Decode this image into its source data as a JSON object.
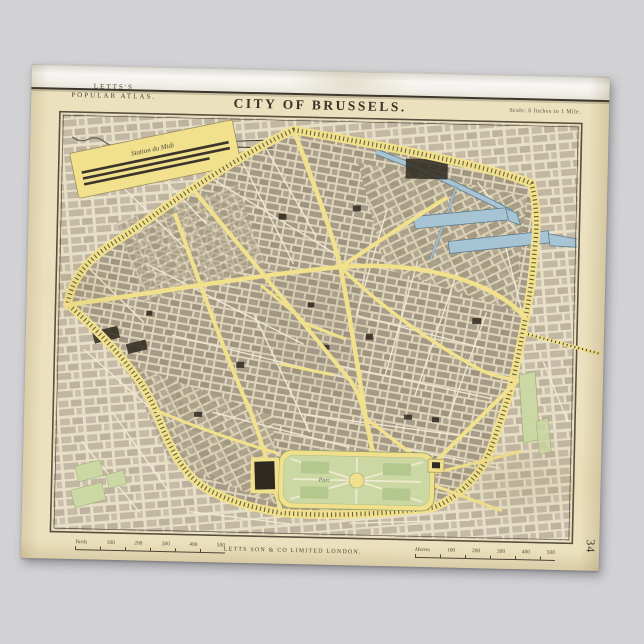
{
  "poster": {
    "series": {
      "line1": "LETTS'S",
      "line2": "POPULAR ATLAS."
    },
    "title": "CITY OF BRUSSELS.",
    "scale_note": "Scale: 6 Inches to 1 Mile.",
    "imprint": "LETTS SON & CO LIMITED LONDON.",
    "plate_number": "34"
  },
  "map": {
    "labels": {
      "station_midi": "Station du Midi",
      "park": "Parc"
    },
    "scalebars": {
      "left": {
        "label": "Yards",
        "ticks": [
          "100",
          "200",
          "300",
          "400",
          "500"
        ]
      },
      "right": {
        "label": "Metres",
        "ticks": [
          "100",
          "200",
          "300",
          "400",
          "500"
        ]
      }
    }
  },
  "colors": {
    "background_gray": "#d2d2d5",
    "paper_tan": "#ece1bf",
    "road_yellow": "#f1e18c",
    "canal_blue": "#a6c4d4",
    "park_green": "#cbd8a3",
    "block_gray": "#aba08c",
    "ink": "#3c352a"
  }
}
